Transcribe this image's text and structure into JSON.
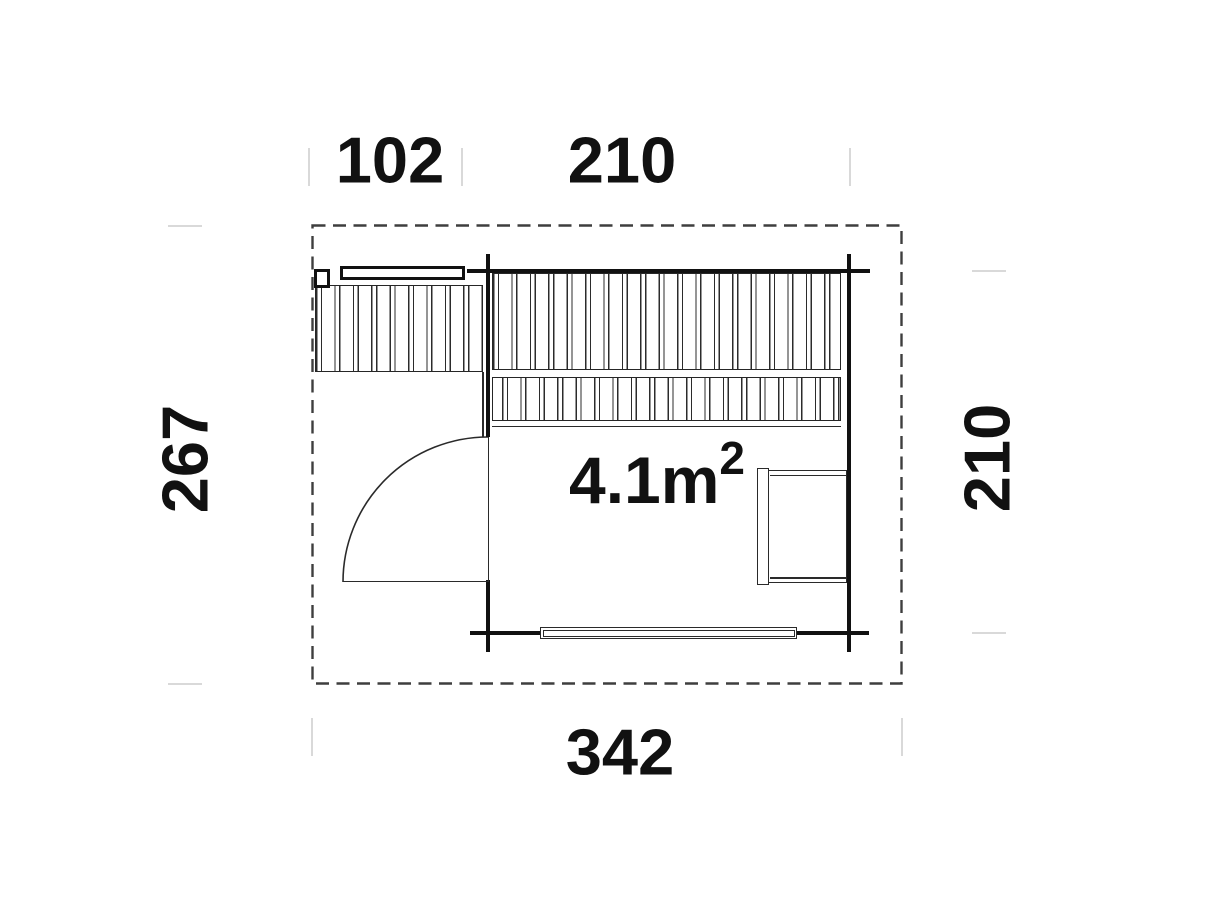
{
  "plan": {
    "title": "floor-plan",
    "area": {
      "main": "4.1m",
      "exponent": "2",
      "full": "4.1m²"
    },
    "dimensions": {
      "top_left": "102",
      "top_right": "210",
      "left": "267",
      "right": "210",
      "bottom": "342"
    },
    "colors": {
      "wall_line": "#111111",
      "thin_line": "#2a2a2a",
      "hatch_line": "#2b2b2b",
      "dashed_outline": "#3e3e3e",
      "dimension_tick": "#d9d9d9",
      "text": "#111111",
      "background": "#ffffff"
    }
  }
}
